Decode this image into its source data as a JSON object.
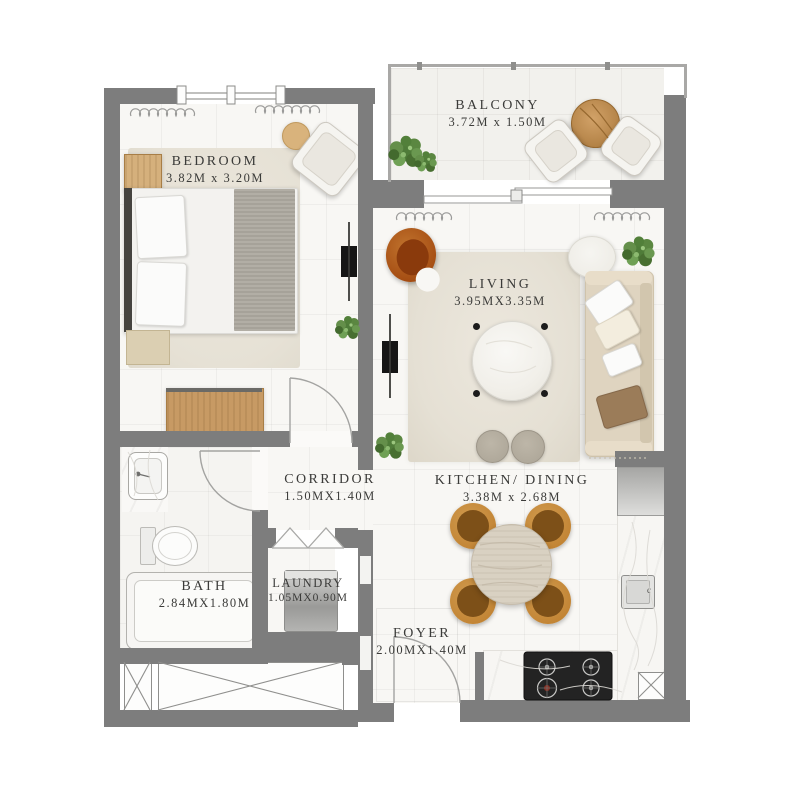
{
  "plan": {
    "title": "One-bedroom apartment floor plan",
    "rooms": [
      {
        "id": "bedroom",
        "name": "BEDROOM",
        "dims": "3.82M x 3.20M"
      },
      {
        "id": "balcony",
        "name": "BALCONY",
        "dims": "3.72M x 1.50M"
      },
      {
        "id": "living",
        "name": "LIVING",
        "dims": "3.95MX3.35M"
      },
      {
        "id": "corridor",
        "name": "CORRIDOR",
        "dims": "1.50MX1.40M"
      },
      {
        "id": "kitchen_dining",
        "name": "KITCHEN/ DINING",
        "dims": "3.38M x 2.68M"
      },
      {
        "id": "bath",
        "name": "BATH",
        "dims": "2.84MX1.80M"
      },
      {
        "id": "laundry",
        "name": "LAUNDRY",
        "dims": "1.05MX0.90M"
      },
      {
        "id": "foyer",
        "name": "FOYER",
        "dims": "2.00MX1.40M"
      }
    ],
    "fixtures": {
      "sink_label": "c"
    },
    "colors": {
      "wall": "#7d7d7d",
      "floor": "#f8f7f4",
      "text": "#3b3b39",
      "rug": "#e6e1d5",
      "wood": "#c79a64",
      "dining_chair": "#c28434",
      "accent_chair": "#a44c12",
      "plant": "#5d8a45"
    }
  }
}
